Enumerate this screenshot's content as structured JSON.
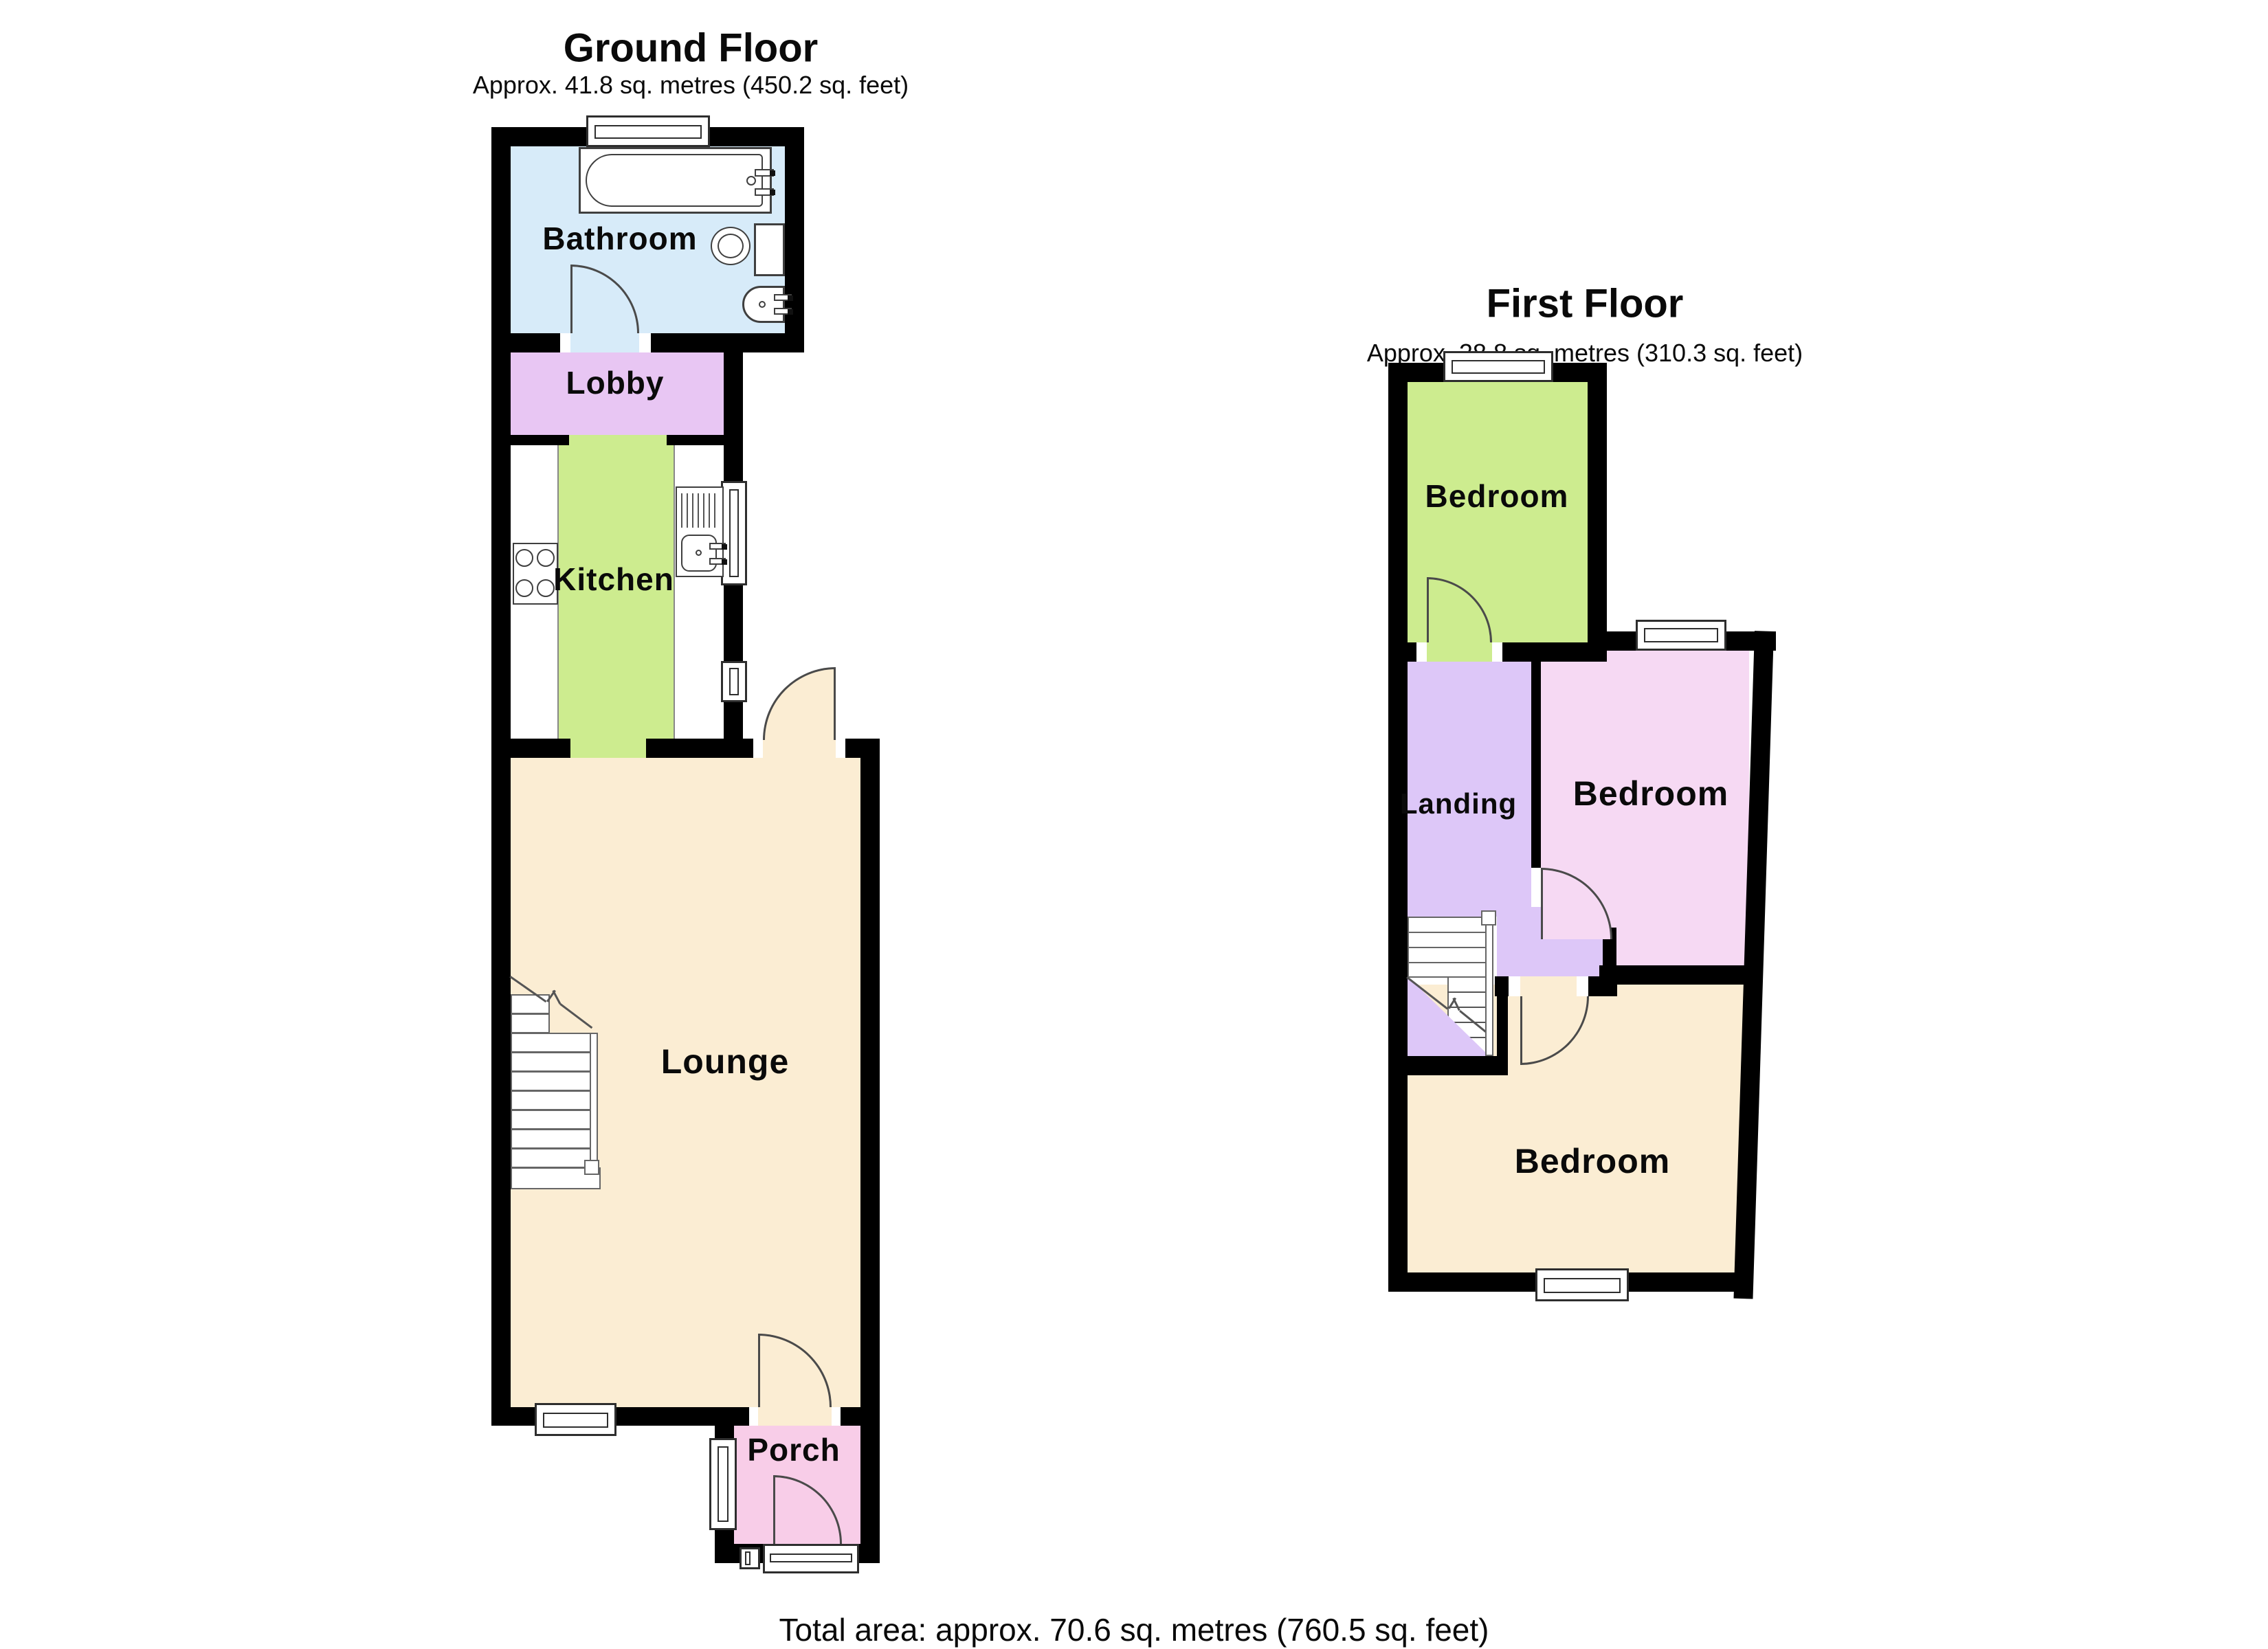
{
  "ground_floor": {
    "title": "Ground Floor",
    "subtitle": "Approx. 41.8 sq. metres (450.2 sq. feet)",
    "rooms": {
      "bathroom": "Bathroom",
      "lobby": "Lobby",
      "kitchen": "Kitchen",
      "lounge": "Lounge",
      "porch": "Porch"
    }
  },
  "first_floor": {
    "title": "First Floor",
    "subtitle": "Approx. 28.8 sq. metres (310.3 sq. feet)",
    "rooms": {
      "bedroom_rear": "Bedroom",
      "landing": "Landing",
      "bedroom_middle": "Bedroom",
      "bedroom_front": "Bedroom"
    }
  },
  "footer": {
    "total_area": "Total area: approx. 70.6 sq. metres (760.5 sq. feet)"
  },
  "colors": {
    "wall": "#000000",
    "bathroom": "#d7ebf9",
    "lobby": "#e8c6f3",
    "kitchen": "#cdec8f",
    "lounge": "#fbedd3",
    "porch": "#f8cde8",
    "bedroom-green": "#cdec8f",
    "landing": "#ddc7f8",
    "bedroom-pink": "#f6d9f3",
    "bedroom-cream": "#fbedd3",
    "fixture-line": "#3f3f3f"
  }
}
